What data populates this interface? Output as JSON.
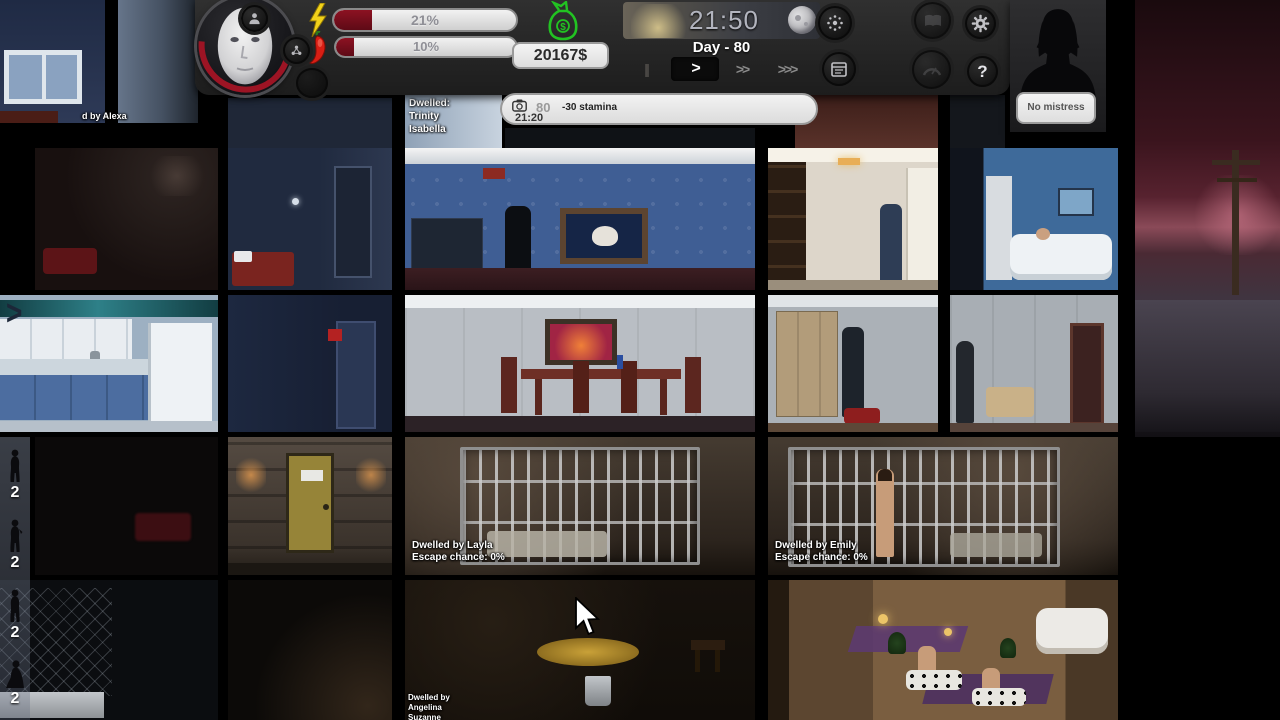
{
  "hud": {
    "stats": [
      {
        "name": "energy",
        "icon": "lightning-icon",
        "label": "21%",
        "percent": 21
      },
      {
        "name": "lust",
        "icon": "chili-icon",
        "label": "10%",
        "percent": 10
      }
    ],
    "money": {
      "icon": "money-bag-icon",
      "value": "20167$"
    },
    "time": {
      "clock": "21:50",
      "day": "Day - 80"
    },
    "speed": {
      "pause": "||",
      "play": ">",
      "fast": ">>",
      "fastest": ">>>"
    },
    "help_label": "?",
    "mistress": {
      "label": "No mistress"
    }
  },
  "event_bar": {
    "day": "80",
    "time": "21:20",
    "message": "-30 stamina"
  },
  "labels": {
    "alexa": "d by Alexa",
    "trinity": [
      "Dwelled:",
      "Trinity",
      "Isabella"
    ],
    "layla": [
      "Dwelled by Layla",
      "Escape chance: 0%"
    ],
    "emily": [
      "Dwelled by Emily",
      "Escape chance: 0%"
    ],
    "angelina": [
      "Dwelled by",
      "Angelina",
      "Suzanne"
    ]
  },
  "sidebar": {
    "counts": [
      "2",
      "2",
      "2",
      "2"
    ]
  },
  "ui": {
    "expand_arrow": ">"
  },
  "colors": {
    "bar_fill": "#7a0e1c",
    "money_green": "#22c322",
    "hud_bg": "#262626",
    "label_white": "#ffffff"
  }
}
